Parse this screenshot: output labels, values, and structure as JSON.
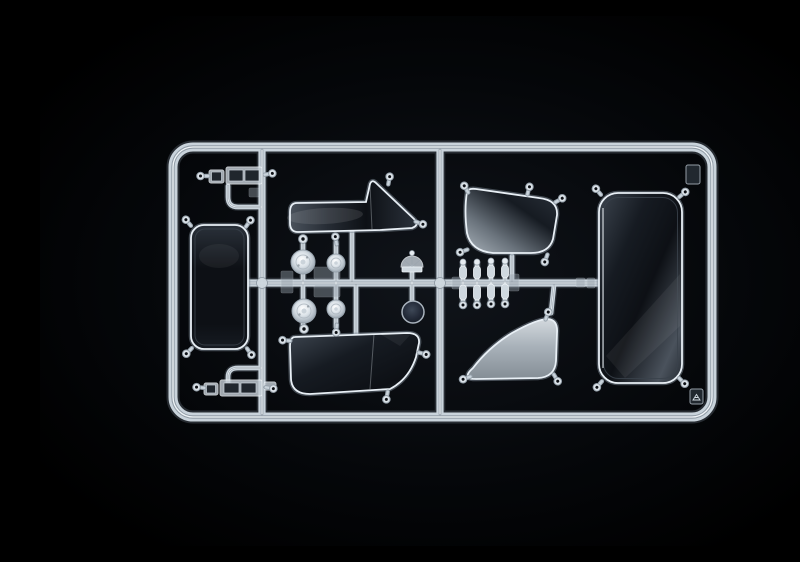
{
  "meta": {
    "title": "Clear-parts sprue of a model kit — transparent windows, mirror glass and lenses photographed on a black background"
  },
  "parts": {
    "frame": "Rectangular sprue frame",
    "runners": "Internal runner rails",
    "mirror_glass": "Rear-view mirror glass pane",
    "mirror_bracket_upper": "Mirror bracket assembly (upper left)",
    "mirror_bracket_lower": "Mirror bracket assembly (lower left)",
    "strip_window": "Side window strip with triangular vent pane",
    "quarter_window_upper": "Curved quarter window (upper)",
    "quarter_window_lower": "Curved quarter window (lower)",
    "door_window": "Door window pane",
    "windscreen": "Large windscreen pane",
    "headlight_lens_left": "Headlight lenses, large pair",
    "headlight_lens_right": "Headlight lenses, small pair",
    "fan_lens": "Fan-shaped lamp lens",
    "round_lens_dark": "Round tinted lens",
    "indicator_stalks": "Indicator lamp stalk parts",
    "corner_tab_top": "Moulding tab, top-right corner",
    "corner_tab_bottom": "Moulding tab with arrow mark, bottom-right corner",
    "gate": "Sprue gate ring"
  },
  "colors": {
    "black": "#000000",
    "near_black": "#05070a",
    "background_center": "#10141a",
    "plastic_glow": "#4a525b",
    "plastic_light": "#c9d3db",
    "plastic_core": "#929da7",
    "highlight": "#f5f9fc",
    "pane_dark_hi": "#3c444e",
    "pane_dark_mid": "#161b22",
    "pane_dark_low": "#0d1015",
    "pane_dark_edge": "#2a313a",
    "slate_hi": "#4a525c",
    "slate_mid": "#262c34",
    "gray_light": "#d3d9de",
    "gray_mid": "#a9b2ba",
    "gray_low": "#848d95",
    "gray_deep": "#6a737c",
    "lens_white": "#ffffff",
    "lens_mid": "#dce3e9",
    "lens_rim": "#94a0ab",
    "dark_lens_hi": "#3e4857",
    "dark_lens_mid": "#242b39",
    "dark_lens_low": "#151b25"
  }
}
